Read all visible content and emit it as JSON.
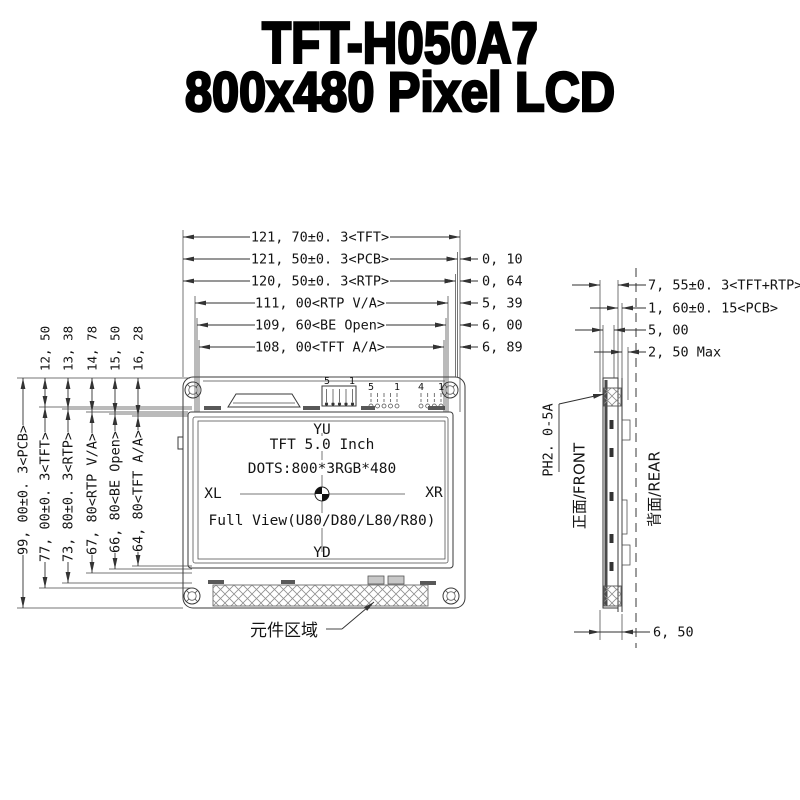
{
  "title": {
    "line1": "TFT-H050A7",
    "line2": "800x480 Pixel LCD"
  },
  "dims": {
    "top": [
      "121, 70±0. 3<TFT>",
      "121, 50±0. 3<PCB>",
      "120, 50±0. 3<RTP>",
      "111, 00<RTP V/A>",
      "109, 60<BE Open>",
      "108, 00<TFT A/A>"
    ],
    "top_offsets": [
      "0, 10",
      "0, 64",
      "5, 39",
      "6, 00",
      "6, 89"
    ],
    "left_small": [
      "12, 50",
      "13, 38",
      "14, 78",
      "15, 50",
      "16, 28"
    ],
    "left_long": [
      "99, 00±0. 3<PCB>",
      "77, 00±0. 3<TFT>",
      "73, 80±0. 3<RTP>",
      "67, 80<RTP V/A>",
      "66, 80<BE Open>",
      "64, 80<TFT A/A>"
    ],
    "side": [
      "7, 55±0. 3<TFT+RTP>",
      "1, 60±0. 15<PCB>",
      "5, 00",
      "2, 50 Max"
    ],
    "side_bottom": "6, 50"
  },
  "screen": {
    "axis_top": "YU",
    "axis_bottom": "YD",
    "axis_left": "XL",
    "axis_right": "XR",
    "line1": "TFT 5.0 Inch",
    "line2": "DOTS:800*3RGB*480",
    "line3": "Full View(U80/D80/L80/R80)"
  },
  "pins": {
    "block1_first": "5",
    "block1_last": "1",
    "block2_first": "5",
    "block2_last": "1",
    "block3_first": "4",
    "block3_last": "1"
  },
  "labels": {
    "component_area": "元件区域",
    "connector": "PH2. 0-5A",
    "front_side": "正面/FRONT",
    "rear_side": "背面/REAR"
  },
  "colors": {
    "line": "#3a3a3a",
    "text": "#141414",
    "pad": "#585858",
    "hatch": "#8f8f8f"
  }
}
